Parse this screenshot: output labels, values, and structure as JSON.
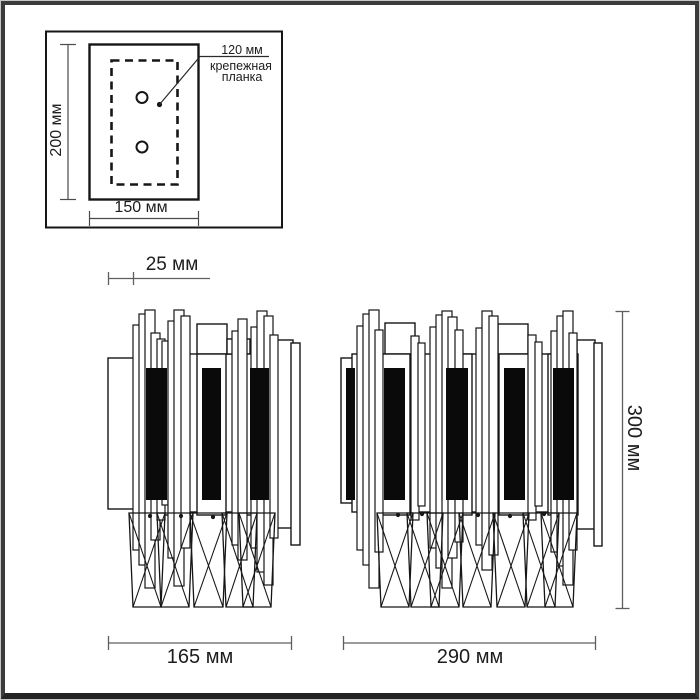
{
  "figure": {
    "kind": "wall-sconce technical dimension drawing",
    "units": "мм",
    "views": 3
  },
  "mounting_inset": {
    "height_label": "200 мм",
    "width_label": "150 мм",
    "plate_width_label": "120 мм",
    "plate_caption_line1": "крепежная",
    "plate_caption_line2": "планка",
    "screw_holes": 2
  },
  "dimensions": {
    "wall_offset_label": "25 мм",
    "single_view_width_label": "165 мм",
    "double_view_width_label": "290 мм",
    "height_label": "300 мм"
  },
  "counts": {
    "single_view_black_panels": 3,
    "double_view_black_panels": 5
  },
  "colors": {
    "background": "#ffffff",
    "line": "#161616",
    "panel_fill": "#0a0a0a",
    "dimension": "#5f5f5f",
    "inset_dimension": "#4a4a4a",
    "frame": "#3b3b3b"
  }
}
